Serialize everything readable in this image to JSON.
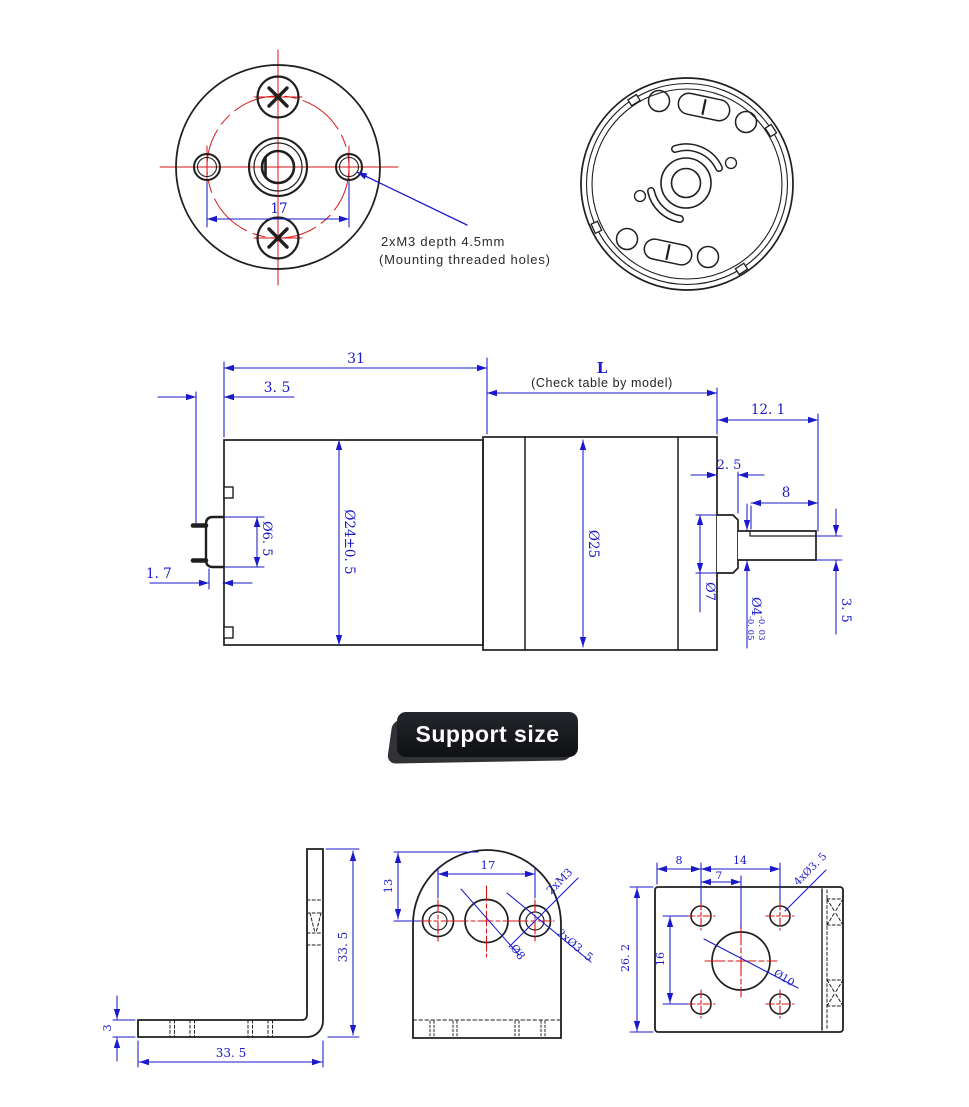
{
  "colors": {
    "dimension_blue": "#1a1acb",
    "centerline_red": "#d91515",
    "line_black": "#1f1f1f",
    "badge_bg": "#1b1d21",
    "badge_text": "#ffffff"
  },
  "front_view": {
    "bolt_spacing": "17",
    "note_line1": "2xM3 depth 4.5mm",
    "note_line2": "(Mounting threaded holes)"
  },
  "side_view": {
    "motor_length": "31",
    "rear_offset": "3. 5",
    "gear_length": "L",
    "gear_length_note": "(Check table by model)",
    "shaft_total": "12. 1",
    "boss_width": "2. 5",
    "shaft_length": "8",
    "rear_boss_dia": "Ø6. 5",
    "motor_dia": "Ø24±0. 5",
    "gearbox_dia": "Ø25",
    "shaft_dia": "Ø4",
    "shaft_dia_tol_upper": "-0. 03",
    "shaft_dia_tol_lower": "-0. 05",
    "boss_dia": "Ø7",
    "shaft_flat": "3. 5",
    "terminal_offset": "1. 7"
  },
  "badge": {
    "label": "Support size"
  },
  "bracket_side": {
    "height": "33. 5",
    "width": "33. 5",
    "thickness": "3"
  },
  "bracket_front": {
    "hole_spacing": "17",
    "top_offset": "13",
    "leader_m3": "2xM3",
    "leader_d35": "2xØ3. 5",
    "center_hole": "Ø8"
  },
  "bracket_bottom": {
    "edge_offset": "8",
    "hole_spacing_x": "14",
    "center_offset": "7",
    "hole_spacing_y": "16",
    "plate_width": "26. 2",
    "leader_holes": "4xØ3. 5",
    "center_hole": "Ø10"
  }
}
